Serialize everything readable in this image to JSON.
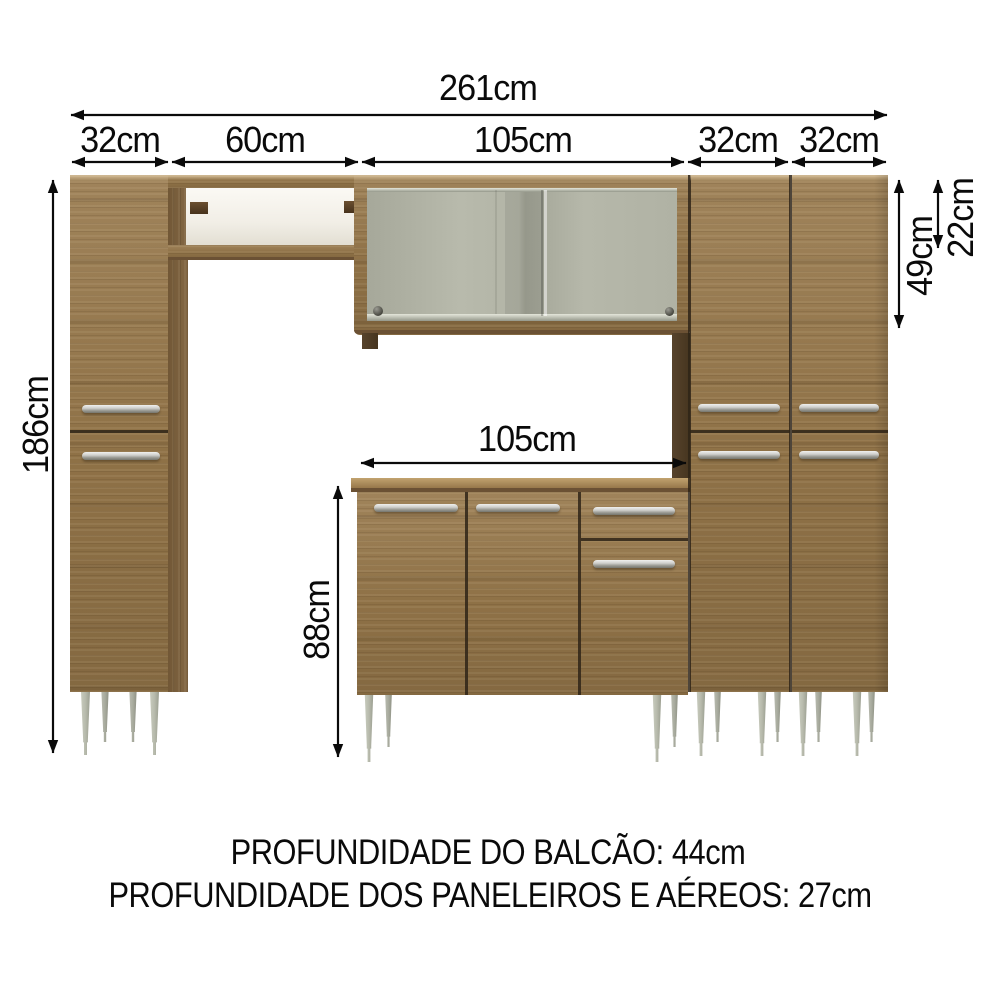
{
  "dimensions": {
    "total_width": "261cm",
    "segments": [
      "32cm",
      "60cm",
      "105cm",
      "32cm",
      "32cm"
    ],
    "left_height": "186cm",
    "upper_cabinet_height": "49cm",
    "niche_height": "22cm",
    "counter_width": "105cm",
    "counter_height": "88cm"
  },
  "footer": {
    "line1": "PROFUNDIDADE DO BALCÃO: 44cm",
    "line2": "PROFUNDIDADE DOS PANELEIROS E AÉREOS: 27cm"
  },
  "colors": {
    "wood": "#96774a",
    "wood_dark": "#7c5f3a",
    "wood_light": "#c2a36f",
    "seam": "#2f2418",
    "edge": "#6b5134",
    "glass": "#b0b2a4",
    "niche_back": "#f1eee6",
    "back_panel": "#57432c",
    "handle_light": "#f0f0ee",
    "handle_dark": "#75756d",
    "leg_light": "#d2d5c8",
    "leg_dark": "#898c7e",
    "ink": "#0a0a0a"
  }
}
